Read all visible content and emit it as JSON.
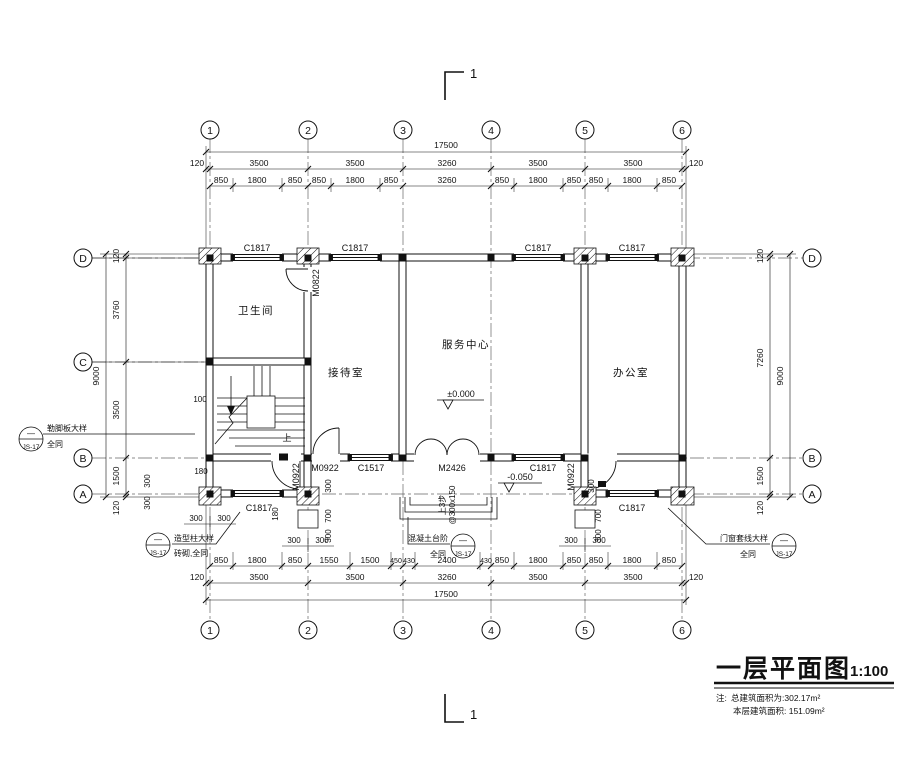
{
  "grid": {
    "cols": [
      "1",
      "2",
      "3",
      "4",
      "5",
      "6"
    ],
    "rows": [
      "D",
      "C",
      "B",
      "A"
    ]
  },
  "section_mark": {
    "top": "1",
    "bottom": "1"
  },
  "dimensions": {
    "top": {
      "total": "17500",
      "bays": [
        "120",
        "3500",
        "3500",
        "3260",
        "3500",
        "3500",
        "120"
      ],
      "detail": [
        "850",
        "1800",
        "850",
        "850",
        "1800",
        "850",
        "3260",
        "850",
        "1800",
        "850",
        "850",
        "1800",
        "850"
      ]
    },
    "bottom": {
      "total": "17500",
      "bays": [
        "120",
        "3500",
        "3500",
        "3260",
        "3500",
        "3500",
        "120"
      ],
      "detail": [
        "850",
        "1800",
        "850",
        "1550",
        "1500",
        "450",
        "430",
        "2400",
        "430",
        "850",
        "1800",
        "850",
        "850",
        "1800",
        "850"
      ]
    },
    "left": {
      "total": "9000",
      "segments": [
        "120",
        "3760",
        "3500",
        "1500",
        "120"
      ]
    },
    "right": {
      "total": "9000",
      "segments": [
        "120",
        "7260",
        "1500",
        "120"
      ]
    },
    "small": {
      "n100": "100",
      "n180": "180",
      "n300": "300",
      "n700": "700"
    }
  },
  "rooms": {
    "bathroom": "卫生间",
    "reception": "接待室",
    "service": "服务中心",
    "office": "办公室"
  },
  "openings": {
    "C1817": "C1817",
    "C1517": "C1517",
    "M2426": "M2426",
    "M0922": "M0922",
    "M0822": "M0822"
  },
  "elevations": {
    "zero": "±0.000",
    "neg": "-0.050"
  },
  "stair": {
    "up": "上",
    "note1": "上3步",
    "note2": "@300x150"
  },
  "callouts": {
    "left": {
      "line1": "勒脚板大样",
      "line2": "全同",
      "dash": "—",
      "ref": "JS-17"
    },
    "column": {
      "line1": "造型柱大样",
      "line2": "砖砌,全同",
      "dash": "—",
      "ref": "JS-17"
    },
    "steps": {
      "line1": "混凝土台阶",
      "line2": "全同",
      "dash": "—",
      "ref": "JS-17"
    },
    "trim": {
      "line1": "门窗套线大样",
      "line2": "全同",
      "dash": "—",
      "ref": "JS-17"
    }
  },
  "title_block": {
    "title": "一层平面图",
    "scale": "1:100",
    "note_label": "注:",
    "note1": "总建筑面积为:302.17m²",
    "note2": "本层建筑面积: 151.09m²"
  }
}
